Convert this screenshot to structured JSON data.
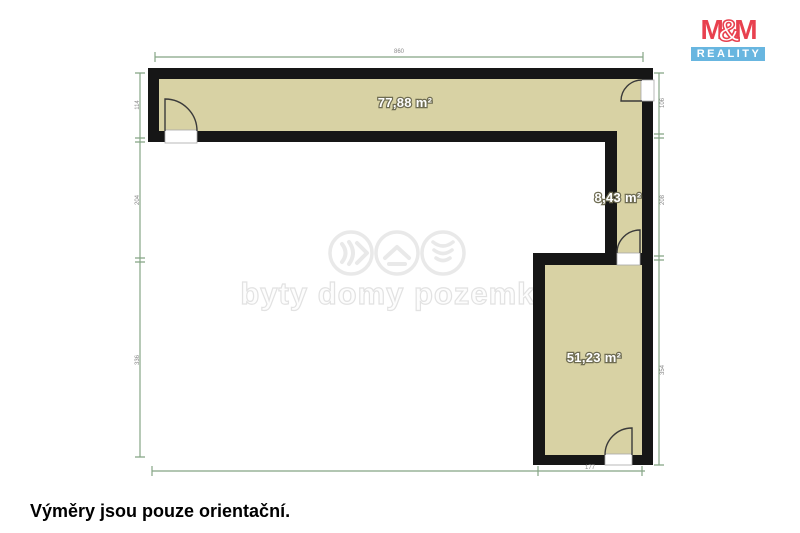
{
  "floor_plan": {
    "rooms": [
      {
        "name": "top-room",
        "label": "77,88 m²"
      },
      {
        "name": "corridor",
        "label": "8,43 m²"
      },
      {
        "name": "bottom-room",
        "label": "51,23 m²"
      }
    ],
    "dimensions": {
      "top": "860",
      "bottom": "177",
      "left": [
        "114",
        "204",
        "336"
      ],
      "right": [
        "106",
        "208",
        "354"
      ]
    },
    "colors": {
      "room_fill": "#d8d2a4",
      "wall": "#161616",
      "dimension_line": "#85a585"
    }
  },
  "watermark": {
    "text": "byty domy pozemky"
  },
  "logo": {
    "m_left": "M",
    "ampersand": "&",
    "m_right": "M",
    "subtitle": "REALITY",
    "red": "#e8414f",
    "blue": "#68b6e0"
  },
  "caption": "Výměry jsou pouze orientační."
}
